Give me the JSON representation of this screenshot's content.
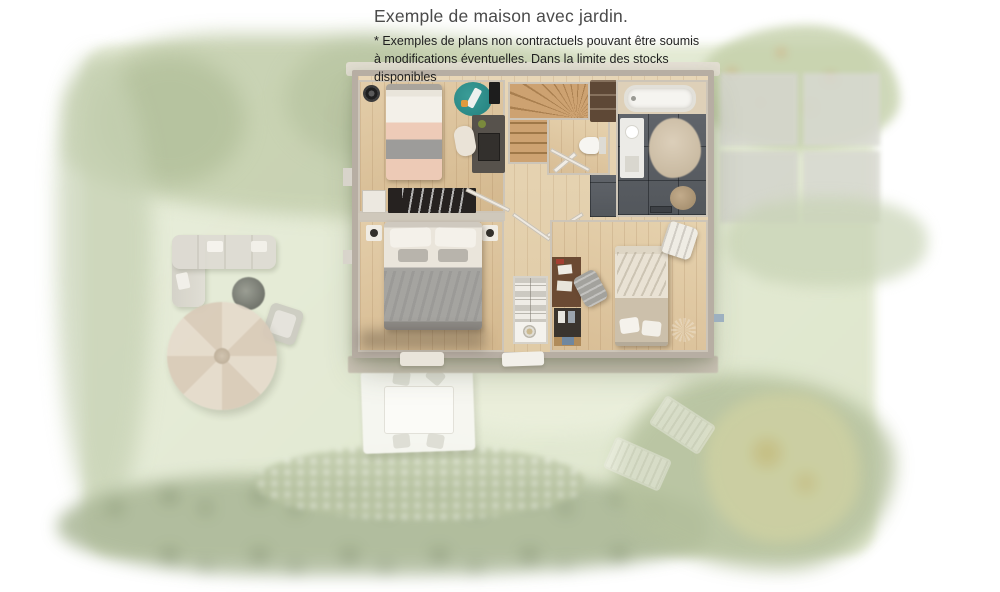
{
  "header": {
    "title": "Exemple de maison avec jardin.",
    "disclaimer_line1": "* Exemples de plans non contractuels pouvant être soumis",
    "disclaimer_line2": "à modifications éventuelles. Dans la limite des stocks disponibles"
  },
  "palette": {
    "background": "#ffffff",
    "title_color": "#4a4a4a",
    "disclaimer_color": "#1f1f1f",
    "grass": "#e3e9d4",
    "tree_light": "#c2cdab",
    "tree_dark": "#a9b695",
    "autumn_tree": "#cdd0a2",
    "paver": "#d6d6d0",
    "wall": "#b7aea3",
    "facade": "#cbc3b6",
    "wood_floor": "#ddc49e",
    "stair_wood": "#c89f6f",
    "bathroom_tile": "#5b5f64",
    "teal_rug": "#2f8f8d",
    "pink_bedding": "#eccdbb",
    "gray_blanket": "#a5a4a0",
    "tan_bedding": "#ccc0ab",
    "parasol": "#e3d6c6"
  },
  "scene": {
    "garden_items": [
      "tree borders",
      "grass lawn",
      "outdoor corner sofa",
      "fire-pit table",
      "garden chair",
      "parasol",
      "terrace slab",
      "dining table with four chairs",
      "two sun loungers",
      "flower bed",
      "autumn tree",
      "paver patio"
    ],
    "house_rooms": [
      "bedroom with desk and teal rug",
      "winder staircase",
      "wc",
      "bathroom with bathtub",
      "master bedroom",
      "linen closet",
      "bedroom with desk and armchair",
      "hallway"
    ]
  }
}
